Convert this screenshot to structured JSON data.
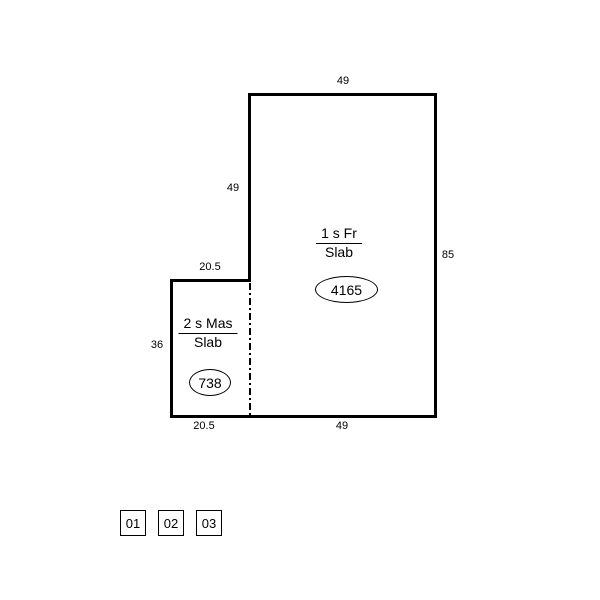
{
  "colors": {
    "background": "#ffffff",
    "line": "#000000"
  },
  "building1": {
    "story": "1 s Fr",
    "foundation": "Slab",
    "area": "4165",
    "dim_top": "49",
    "dim_left": "49",
    "dim_right": "85",
    "dim_bottom": "49"
  },
  "building2": {
    "story": "2 s Mas",
    "foundation": "Slab",
    "area": "738",
    "dim_top": "20.5",
    "dim_left": "36",
    "dim_bottom": "20.5"
  },
  "pages": [
    {
      "label": "01"
    },
    {
      "label": "02"
    },
    {
      "label": "03"
    }
  ]
}
